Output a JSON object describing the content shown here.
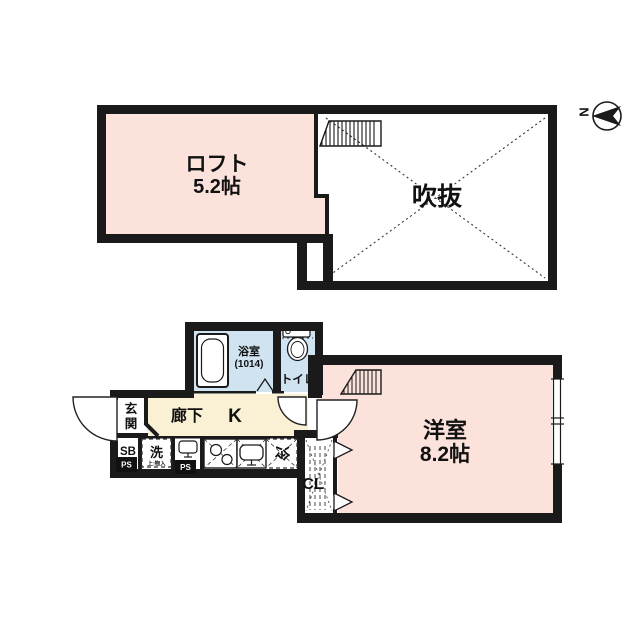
{
  "colors": {
    "wall": "#1a1a1a",
    "pink": "#fbe3dc",
    "blue": "#cfe3f1",
    "cream": "#faf0d4",
    "beige": "#f7efd7"
  },
  "plan": {
    "upper": {
      "loft_label": "ロフト",
      "loft_size": "5.2帖",
      "void_label": "吹抜"
    },
    "compass": {
      "north_label": "N"
    },
    "lower": {
      "bath_label": "浴室",
      "bath_size": "(1014)",
      "toilet_label": "トイレ",
      "entrance_label_top": "玄",
      "entrance_label_bottom": "関",
      "hallway_label": "廊下",
      "kitchen_label": "K",
      "shoebox_label": "SB",
      "washer_label": "洗",
      "washer_note": "上:物入",
      "fridge_label": "冷",
      "closet_label": "CL",
      "ps_label": "PS",
      "room_label": "洋室",
      "room_size": "8.2帖"
    }
  }
}
